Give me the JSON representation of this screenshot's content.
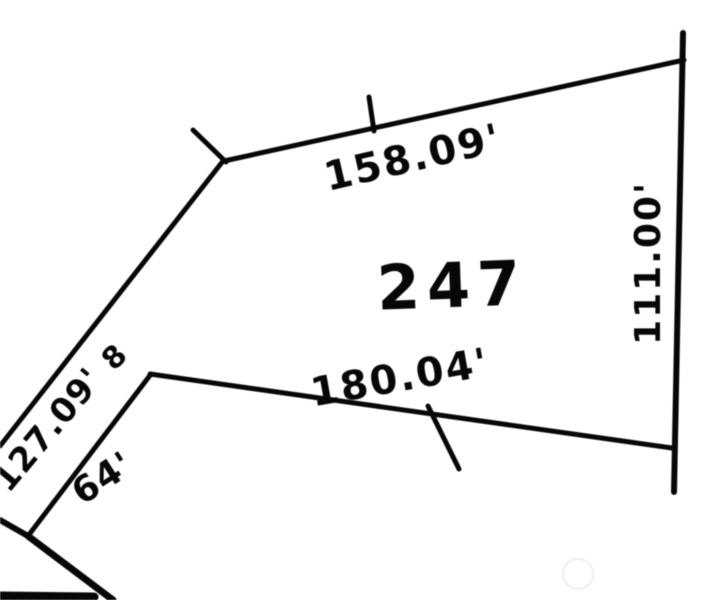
{
  "canvas": {
    "width": 704,
    "height": 600,
    "background": "#fdfdfd",
    "ink": "#0d0d0d",
    "watermark_circle_color": "#ececec"
  },
  "parcel": {
    "lot_number": "247",
    "dimensions": {
      "top_boundary": "158.09'",
      "right_boundary": "111.00'",
      "bottom_boundary": "180.04'",
      "left_diagonal_boundary": "127.09'",
      "short_side": "64'",
      "corner_mark": "8"
    }
  },
  "labels": [
    {
      "name": "dim-top-boundary",
      "text": "158.09'",
      "x": 413,
      "y": 158,
      "rotate": -13,
      "size": 40,
      "weight": 700,
      "spacing": 2
    },
    {
      "name": "dim-right-boundary",
      "text": "111.00'",
      "x": 649,
      "y": 263,
      "rotate": -90,
      "size": 36,
      "weight": 700,
      "spacing": 2
    },
    {
      "name": "lot-number",
      "text": "247",
      "x": 452,
      "y": 286,
      "rotate": -2,
      "size": 62,
      "weight": 800,
      "spacing": 7
    },
    {
      "name": "dim-bottom-boundary",
      "text": "180.04'",
      "x": 400,
      "y": 378,
      "rotate": -10,
      "size": 40,
      "weight": 700,
      "spacing": 2
    },
    {
      "name": "dim-left-diagonal",
      "text": "127.09'",
      "x": 48,
      "y": 430,
      "rotate": -50,
      "size": 34,
      "weight": 700,
      "spacing": 1
    },
    {
      "name": "corner-mark-8",
      "text": "8",
      "x": 115,
      "y": 358,
      "rotate": -45,
      "size": 30,
      "weight": 700,
      "spacing": 0
    },
    {
      "name": "dim-short-side",
      "text": "64'",
      "x": 103,
      "y": 479,
      "rotate": -33,
      "size": 36,
      "weight": 700,
      "spacing": 1
    }
  ],
  "map_geometry": {
    "lines": [
      {
        "name": "corner-stub-northwest",
        "x1": 193,
        "y1": 130,
        "x2": 226,
        "y2": 162,
        "w": 5
      },
      {
        "name": "boundary-top",
        "x1": 224,
        "y1": 161,
        "x2": 684,
        "y2": 60,
        "w": 5
      },
      {
        "name": "tick-top-boundary",
        "x1": 369,
        "y1": 97,
        "x2": 374,
        "y2": 131,
        "w": 5
      },
      {
        "name": "boundary-right",
        "x1": 683,
        "y1": 33,
        "x2": 674,
        "y2": 492,
        "w": 6
      },
      {
        "name": "boundary-bottom",
        "x1": 150,
        "y1": 374,
        "x2": 672,
        "y2": 448,
        "w": 5
      },
      {
        "name": "tick-bottom-boundary",
        "x1": 428,
        "y1": 406,
        "x2": 459,
        "y2": 469,
        "w": 5
      },
      {
        "name": "boundary-left-diagonal",
        "x1": 223,
        "y1": 161,
        "x2": 0,
        "y2": 446,
        "w": 5
      },
      {
        "name": "road-edge-diagonal",
        "x1": 151,
        "y1": 374,
        "x2": 28,
        "y2": 536,
        "w": 5
      },
      {
        "name": "branch-west",
        "x1": 28,
        "y1": 536,
        "x2": 0,
        "y2": 520,
        "w": 6
      },
      {
        "name": "branch-south",
        "x1": 28,
        "y1": 536,
        "x2": 113,
        "y2": 600,
        "w": 7
      },
      {
        "name": "bottom-edge-bar",
        "x1": 0,
        "y1": 596,
        "x2": 94,
        "y2": 597,
        "w": 9
      }
    ],
    "watermark_circle": {
      "cx": 578,
      "cy": 574,
      "r": 15,
      "w": 3
    }
  }
}
